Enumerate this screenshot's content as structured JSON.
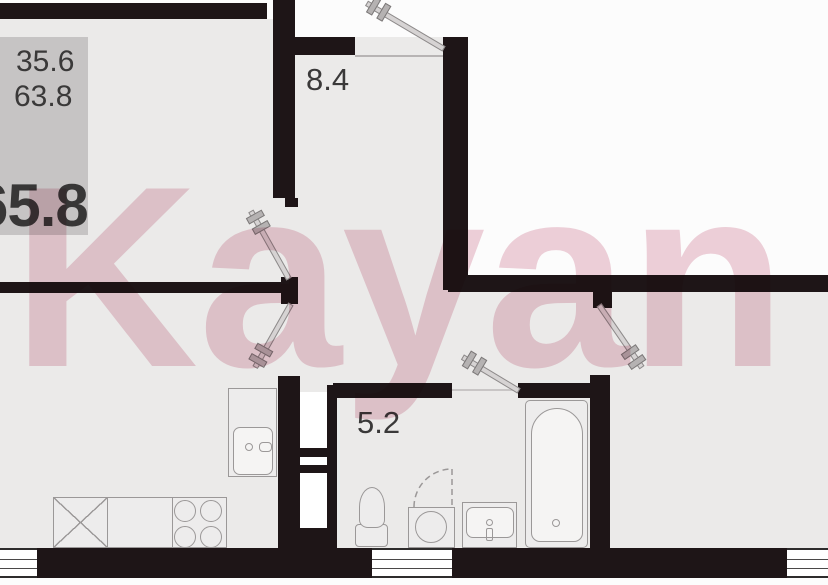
{
  "watermark": {
    "text": "Kayan",
    "color": "#dfa3b5"
  },
  "info_box": {
    "value_top": "35.6",
    "value_middle": "63.8",
    "value_bottom_bold": "65.8",
    "bg": "#c6c4c4"
  },
  "room_labels": {
    "hallway_area": "8.4",
    "bathroom_area": "5.2"
  },
  "colors": {
    "wall": "#1e1517",
    "room_fill": "#ebeae9",
    "outside_fill": "#fcfcfc",
    "fixture_line": "#9b9898",
    "text": "#3a3939"
  },
  "fixtures": [
    "kitchen-cabinet",
    "kitchen-sink",
    "counter",
    "dishwasher-x-box",
    "stove-burners",
    "toilet",
    "vanity-sink",
    "washing-machine",
    "bathtub"
  ],
  "doors_count": 5,
  "windows_count": 3
}
